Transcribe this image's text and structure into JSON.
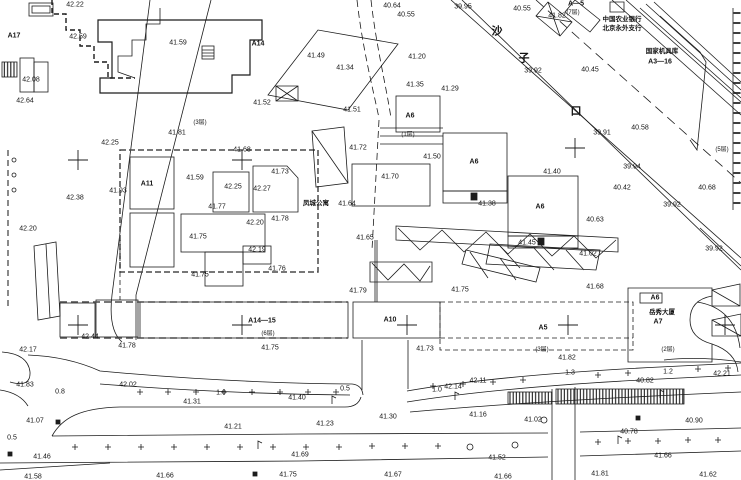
{
  "drawing": {
    "type": "topographic-survey-plan",
    "road_name": "沙子口",
    "ink_color": "#1c1c1c",
    "paper_color": "#ffffff"
  },
  "texts": {
    "bank_line1": "中国农业银行",
    "bank_line2": "北京永外支行",
    "depot_name": "国家机具库",
    "depot_code": "A3—16",
    "apartment_name": "凤城公寓",
    "tower_name": "岳秀大厦"
  },
  "label_groups": [
    {
      "name": "elevation-label",
      "cls": "elev",
      "items": [
        [
          75,
          5,
          "42.22"
        ],
        [
          78,
          37,
          "42.59"
        ],
        [
          178,
          43,
          "41.59"
        ],
        [
          31,
          80,
          "42.08"
        ],
        [
          25,
          101,
          "42.64"
        ],
        [
          392,
          6,
          "40.64"
        ],
        [
          406,
          15,
          "40.55"
        ],
        [
          463,
          7,
          "39.95"
        ],
        [
          522,
          9,
          "40.55"
        ],
        [
          557,
          16,
          "41.82"
        ],
        [
          533,
          71,
          "39.92"
        ],
        [
          590,
          70,
          "40.45"
        ],
        [
          602,
          133,
          "39.91"
        ],
        [
          640,
          128,
          "40.58"
        ],
        [
          632,
          167,
          "39.94"
        ],
        [
          622,
          188,
          "40.42"
        ],
        [
          707,
          188,
          "40.68"
        ],
        [
          672,
          205,
          "39.92"
        ],
        [
          595,
          220,
          "40.63"
        ],
        [
          316,
          56,
          "41.49"
        ],
        [
          417,
          57,
          "41.20"
        ],
        [
          345,
          68,
          "41.34"
        ],
        [
          415,
          85,
          "41.35"
        ],
        [
          450,
          89,
          "41.29"
        ],
        [
          262,
          103,
          "41.52"
        ],
        [
          352,
          110,
          "41.51"
        ],
        [
          110,
          143,
          "42.25"
        ],
        [
          177,
          133,
          "41.81"
        ],
        [
          242,
          150,
          "41.68"
        ],
        [
          358,
          148,
          "41.72"
        ],
        [
          280,
          172,
          "41.73"
        ],
        [
          195,
          178,
          "41.59"
        ],
        [
          233,
          187,
          "42.25"
        ],
        [
          262,
          189,
          "42.27"
        ],
        [
          118,
          191,
          "41.93"
        ],
        [
          75,
          198,
          "42.38"
        ],
        [
          217,
          207,
          "41.77"
        ],
        [
          255,
          223,
          "42.20"
        ],
        [
          280,
          219,
          "41.78"
        ],
        [
          198,
          237,
          "41.75"
        ],
        [
          347,
          204,
          "41.64"
        ],
        [
          365,
          238,
          "41.65"
        ],
        [
          432,
          157,
          "41.50"
        ],
        [
          552,
          172,
          "41.40"
        ],
        [
          390,
          177,
          "41.70"
        ],
        [
          487,
          204,
          "41.38"
        ],
        [
          527,
          243,
          "41.45"
        ],
        [
          588,
          254,
          "41.02"
        ],
        [
          595,
          287,
          "41.68"
        ],
        [
          714,
          249,
          "39.92"
        ],
        [
          28,
          229,
          "42.20"
        ],
        [
          257,
          250,
          "42.19"
        ],
        [
          277,
          269,
          "41.76"
        ],
        [
          358,
          291,
          "41.79"
        ],
        [
          460,
          290,
          "41.75"
        ],
        [
          270,
          348,
          "41.75"
        ],
        [
          425,
          349,
          "41.73"
        ],
        [
          200,
          275,
          "41.75"
        ],
        [
          90,
          337,
          "42.44"
        ],
        [
          28,
          350,
          "42.17"
        ],
        [
          127,
          346,
          "41.78"
        ],
        [
          567,
          358,
          "41.82"
        ],
        [
          25,
          385,
          "41.83"
        ],
        [
          128,
          385,
          "42.02"
        ],
        [
          192,
          402,
          "41.31"
        ],
        [
          35,
          421,
          "41.07"
        ],
        [
          233,
          427,
          "41.21"
        ],
        [
          42,
          457,
          "41.46"
        ],
        [
          33,
          477,
          "41.58"
        ],
        [
          165,
          476,
          "41.66"
        ],
        [
          297,
          398,
          "41.40"
        ],
        [
          453,
          387,
          "42.14"
        ],
        [
          478,
          381,
          "42.11"
        ],
        [
          388,
          417,
          "41.30"
        ],
        [
          478,
          415,
          "41.16"
        ],
        [
          325,
          424,
          "41.23"
        ],
        [
          300,
          455,
          "41.69"
        ],
        [
          288,
          475,
          "41.75"
        ],
        [
          393,
          475,
          "41.67"
        ],
        [
          645,
          381,
          "40.82"
        ],
        [
          533,
          420,
          "41.02"
        ],
        [
          694,
          421,
          "40.90"
        ],
        [
          629,
          432,
          "40.78"
        ],
        [
          497,
          458,
          "41.52"
        ],
        [
          663,
          456,
          "41.66"
        ],
        [
          503,
          477,
          "41.66"
        ],
        [
          600,
          474,
          "41.81"
        ],
        [
          708,
          475,
          "41.62"
        ],
        [
          722,
          374,
          "42.21"
        ]
      ]
    },
    {
      "name": "distance-label",
      "cls": "dist",
      "items": [
        [
          60,
          392,
          "0.8"
        ],
        [
          221,
          393,
          "1.0"
        ],
        [
          12,
          438,
          "0.5"
        ],
        [
          345,
          389,
          "0.5"
        ],
        [
          437,
          390,
          "1.0"
        ],
        [
          570,
          373,
          "1.3"
        ],
        [
          668,
          372,
          "1.2"
        ]
      ]
    },
    {
      "name": "building-code-label",
      "cls": "bld",
      "items": [
        [
          14,
          36,
          "A17"
        ],
        [
          258,
          44,
          "A14"
        ],
        [
          147,
          184,
          "A11"
        ],
        [
          410,
          116,
          "A6"
        ],
        [
          474,
          162,
          "A6"
        ],
        [
          540,
          207,
          "A6"
        ],
        [
          262,
          321,
          "A14—15"
        ],
        [
          390,
          320,
          "A10"
        ],
        [
          543,
          328,
          "A5"
        ],
        [
          658,
          322,
          "A7"
        ],
        [
          655,
          298,
          "A6"
        ],
        [
          576,
          4,
          "A—5"
        ],
        [
          660,
          62,
          "A3—16"
        ]
      ]
    },
    {
      "name": "floor-count-label",
      "cls": "flr",
      "items": [
        [
          573,
          13,
          "(7层)"
        ],
        [
          722,
          150,
          "(5层)"
        ],
        [
          200,
          123,
          "(3层)"
        ],
        [
          408,
          135,
          "(1层)"
        ],
        [
          268,
          334,
          "(6层)"
        ],
        [
          542,
          350,
          "(3层)"
        ],
        [
          668,
          350,
          "(2层)"
        ]
      ]
    },
    {
      "name": "building-name-label",
      "cls": "name",
      "items": [
        [
          622,
          20,
          "中国农业银行"
        ],
        [
          622,
          29,
          "北京永外支行"
        ],
        [
          662,
          52,
          "国家机具库"
        ],
        [
          316,
          204,
          "凤城公寓"
        ],
        [
          662,
          313,
          "岳秀大厦"
        ]
      ]
    },
    {
      "name": "road-name-char",
      "cls": "road",
      "items": [
        [
          497,
          32,
          "沙"
        ],
        [
          524,
          59,
          "子"
        ],
        [
          576,
          112,
          "口"
        ]
      ]
    }
  ]
}
